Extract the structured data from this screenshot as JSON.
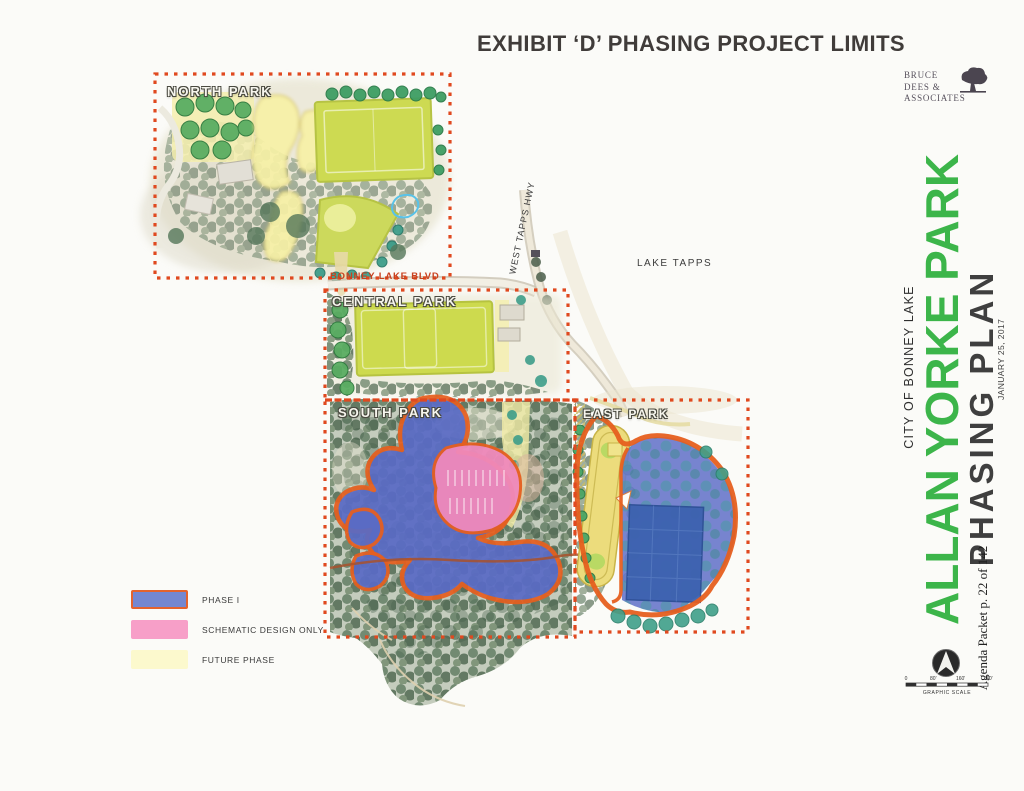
{
  "page": {
    "title": "EXHIBIT ‘D’ PHASING PROJECT LIMITS",
    "background": "#fbfbf8"
  },
  "firm": {
    "lines": [
      "BRUCE",
      "DEES &",
      "ASSOCIATES"
    ]
  },
  "titleblock": {
    "city": "CITY OF BONNEY LAKE",
    "park": "ALLAN YORKE PARK",
    "plan": "PHASING PLAN",
    "date": "JANUARY 25, 2017",
    "agenda": "Agenda Packet p. 22 of 142",
    "park_color": "#3cb54a"
  },
  "map": {
    "areas": [
      {
        "label": "NORTH PARK"
      },
      {
        "label": "CENTRAL PARK"
      },
      {
        "label": "SOUTH PARK"
      },
      {
        "label": "EAST PARK"
      }
    ],
    "roads": [
      {
        "label": "BONNEY LAKE BLVD"
      },
      {
        "label": "WEST TAPPS HWY"
      }
    ],
    "water_label": "LAKE TAPPS"
  },
  "legend": {
    "items": [
      {
        "label": "PHASE I",
        "fill": "#7487d1",
        "border": "#e4632e"
      },
      {
        "label": "SCHEMATIC DESIGN ONLY",
        "fill": "#f79fc8",
        "border": ""
      },
      {
        "label": "FUTURE PHASE",
        "fill": "#fcf9cd",
        "border": ""
      }
    ]
  },
  "scale": {
    "labels": [
      "0",
      "80'",
      "160'",
      "240'"
    ],
    "caption": "GRAPHIC SCALE"
  },
  "colors": {
    "dash_border": "#e0491f",
    "phase_outline": "#e65f1f",
    "phase1_fill": "#5a6bc5",
    "schematic_fill": "#f089bb",
    "future_fill": "#f6efa8",
    "field_green": "#cdda52"
  }
}
